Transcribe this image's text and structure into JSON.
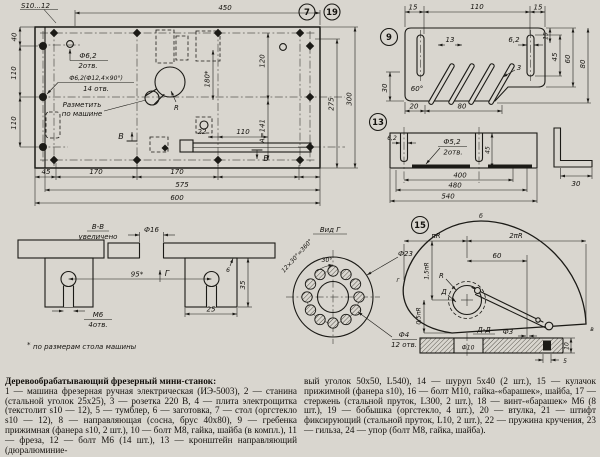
{
  "meta": {
    "paper": "#d9d6cf",
    "ink": "#1b1a16"
  },
  "callouts": {
    "c7": "7",
    "c19": "19",
    "c9": "9",
    "c13": "13",
    "c15": "15"
  },
  "mv": {
    "thickness": "S10...12",
    "d450": "450",
    "d40": "40",
    "d110a": "110",
    "d110b": "110",
    "d275": "275",
    "d300": "300",
    "d45": "45",
    "d170a": "170",
    "d170b": "170",
    "d575": "575",
    "d600": "600",
    "d120": "120",
    "dA": "А=141",
    "d180": "180*",
    "d110c": "110",
    "d22": "22",
    "r": "R",
    "b": "В",
    "hole1a": "Ф6,2",
    "hole1b": "2отв.",
    "hole2a": "Ф6,2(Ф12,4×90°)",
    "hole2b": "14 отв.",
    "mark1": "Разметить",
    "mark2": "по машине"
  },
  "bb": {
    "t1": "В-В",
    "t2": "увеличено",
    "f16": "Ф16",
    "d95": "95*",
    "g": "Г",
    "m6": "М6",
    "m6b": "4отв.",
    "d25": "25",
    "d35": "35",
    "d6": "6",
    "star": "*",
    "fn": "по размерам стола машины"
  },
  "vg": {
    "title": "Вид Г",
    "f23": "Ф23",
    "f4": "Ф4",
    "f4b": "12 отв.",
    "ang": "12×30°=360°",
    "a30": "30°"
  },
  "d9": {
    "d15a": "15",
    "d110": "110",
    "d15b": "15",
    "d13": "13",
    "d62": "6,2",
    "d3": "3",
    "a60": "60°",
    "d30": "30",
    "d15r": "15",
    "d45": "45",
    "d60": "60",
    "d80": "80",
    "d20": "20",
    "d80b": "80"
  },
  "d13": {
    "d62": "6,2",
    "f52": "Ф5,2",
    "f52b": "2отв.",
    "d45": "45",
    "d400": "400",
    "d480": "480",
    "d540": "540",
    "d30": "30"
  },
  "d15": {
    "pir": "πR",
    "pi2r": "2πR",
    "d60": "60",
    "pi15r": "1,5πR",
    "pi05r": "0,5πR",
    "r": "R",
    "d": "Д",
    "pa": "а",
    "pb": "б",
    "pv": "в",
    "pg": "г",
    "f3": "Ф3",
    "dd": "Д-Д",
    "f10": "Ф10",
    "d10": "10",
    "d5": "5"
  },
  "desc": {
    "title": "Деревообрабатывающий фрезерный мини-станок:",
    "col1": "1 — машина фрезерная ручная электрическая (ИЭ-5003), 2 — станина (стальной уголок 25х25), 3 — розетка 220 В, 4 — плита электрощитка (текстолит s10 — 12), 5 — тумблер, 6 — заготовка, 7 — стол (оргстекло s10 — 12), 8 — направляющая (сосна, брус 40х80), 9 — гребенка прижимная (фанера s10, 2 шт.), 10 — болт М8, гайка, шайба (в компл.), 11 — фреза, 12 — болт М6 (14 шт.), 13 — кронштейн направляющий (дюралюминие-",
    "col2": "вый уголок 50х50, L540), 14 — шуруп 5х40 (2 шт.), 15 — кулачок прижимной (фанера s10), 16 — болт М10, гайка-«барашек», шайба, 17 — стержень (стальной пруток, L300, 2 шт.), 18 — винт-«барашек» М6 (8 шт.), 19 — бобышка (оргстекло, 4 шт.), 20 — втулка, 21 — штифт фиксирующий (стальной пруток, L10, 2 шт.), 22 — пружина кручения, 23 — гильза, 24 — упор (болт М8, гайка, шайба)."
  }
}
